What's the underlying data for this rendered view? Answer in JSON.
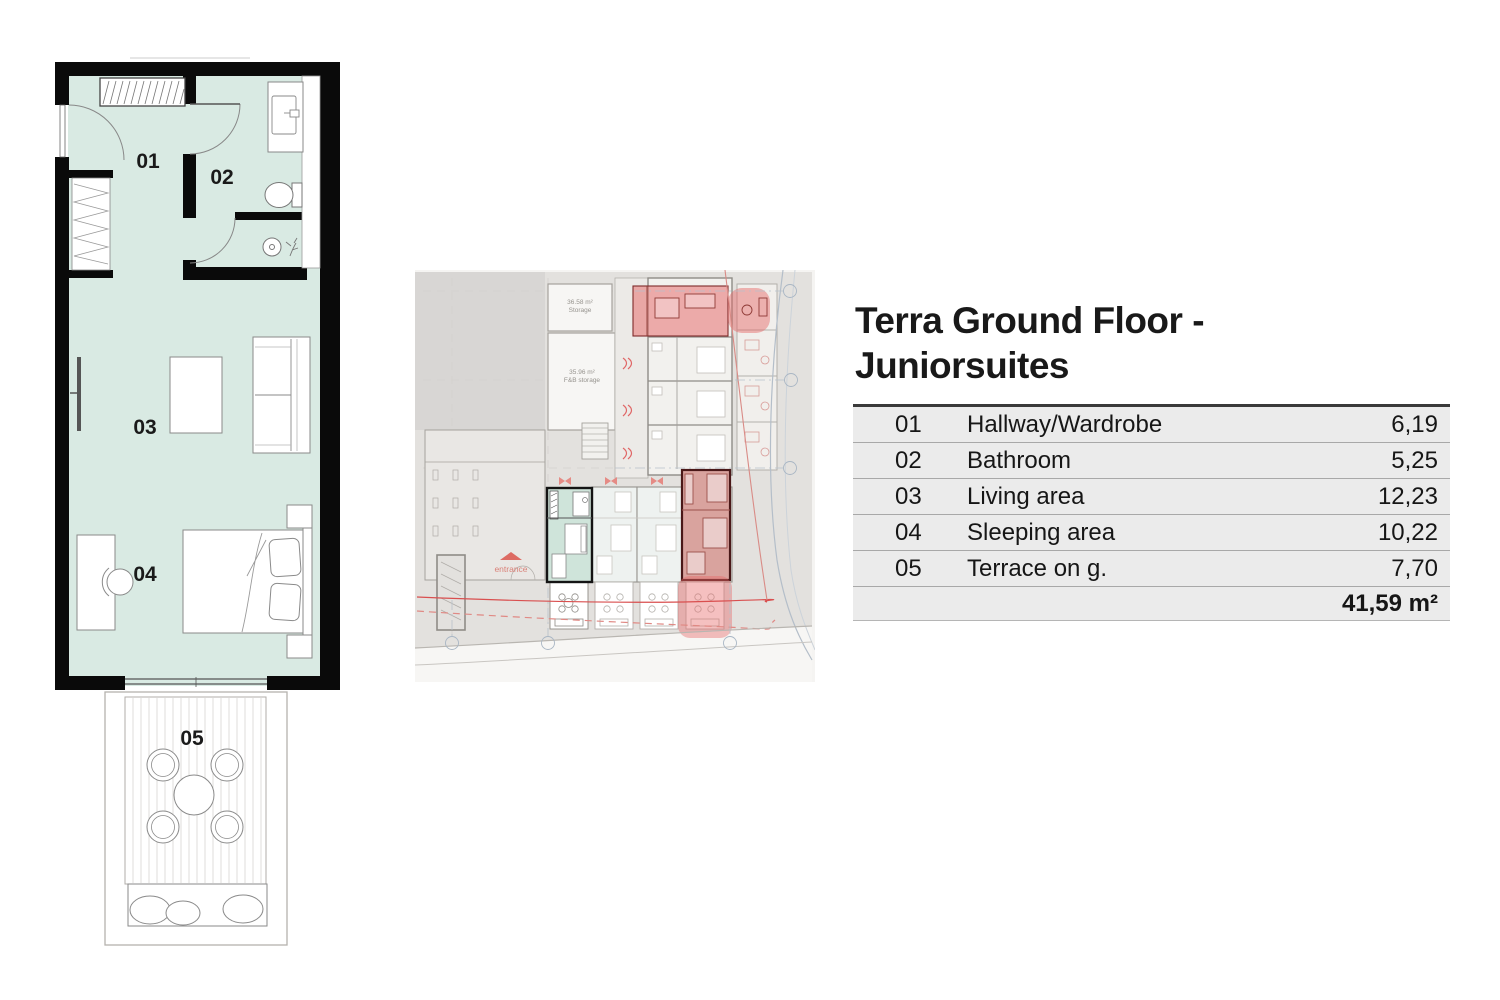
{
  "title": {
    "line1": "Terra Ground Floor -",
    "line2": "Juniorsuites"
  },
  "area_table": {
    "rows": [
      {
        "num": "01",
        "name": "Hallway/Wardrobe",
        "area": "6,19"
      },
      {
        "num": "02",
        "name": "Bathroom",
        "area": "5,25"
      },
      {
        "num": "03",
        "name": "Living area",
        "area": "12,23"
      },
      {
        "num": "04",
        "name": "Sleeping area",
        "area": "10,22"
      },
      {
        "num": "05",
        "name": "Terrace on g.",
        "area": "7,70"
      }
    ],
    "total": "41,59 m²"
  },
  "overview_plan": {
    "storage_label": "36.58 m²",
    "storage_name": "Storage",
    "fb_storage_label": "35.96 m²",
    "fb_storage_name": "F&B storage",
    "entrance_label": "entrance"
  },
  "colors": {
    "room_fill": "#d9eae3",
    "wall": "#0a0a0a",
    "highlight_red": "#e06a6a",
    "highlight_green": "#cfe4da",
    "red_unit_border": "#4a1818",
    "table_bg": "#ebebeb",
    "accent_red_line": "#d94f4f"
  }
}
